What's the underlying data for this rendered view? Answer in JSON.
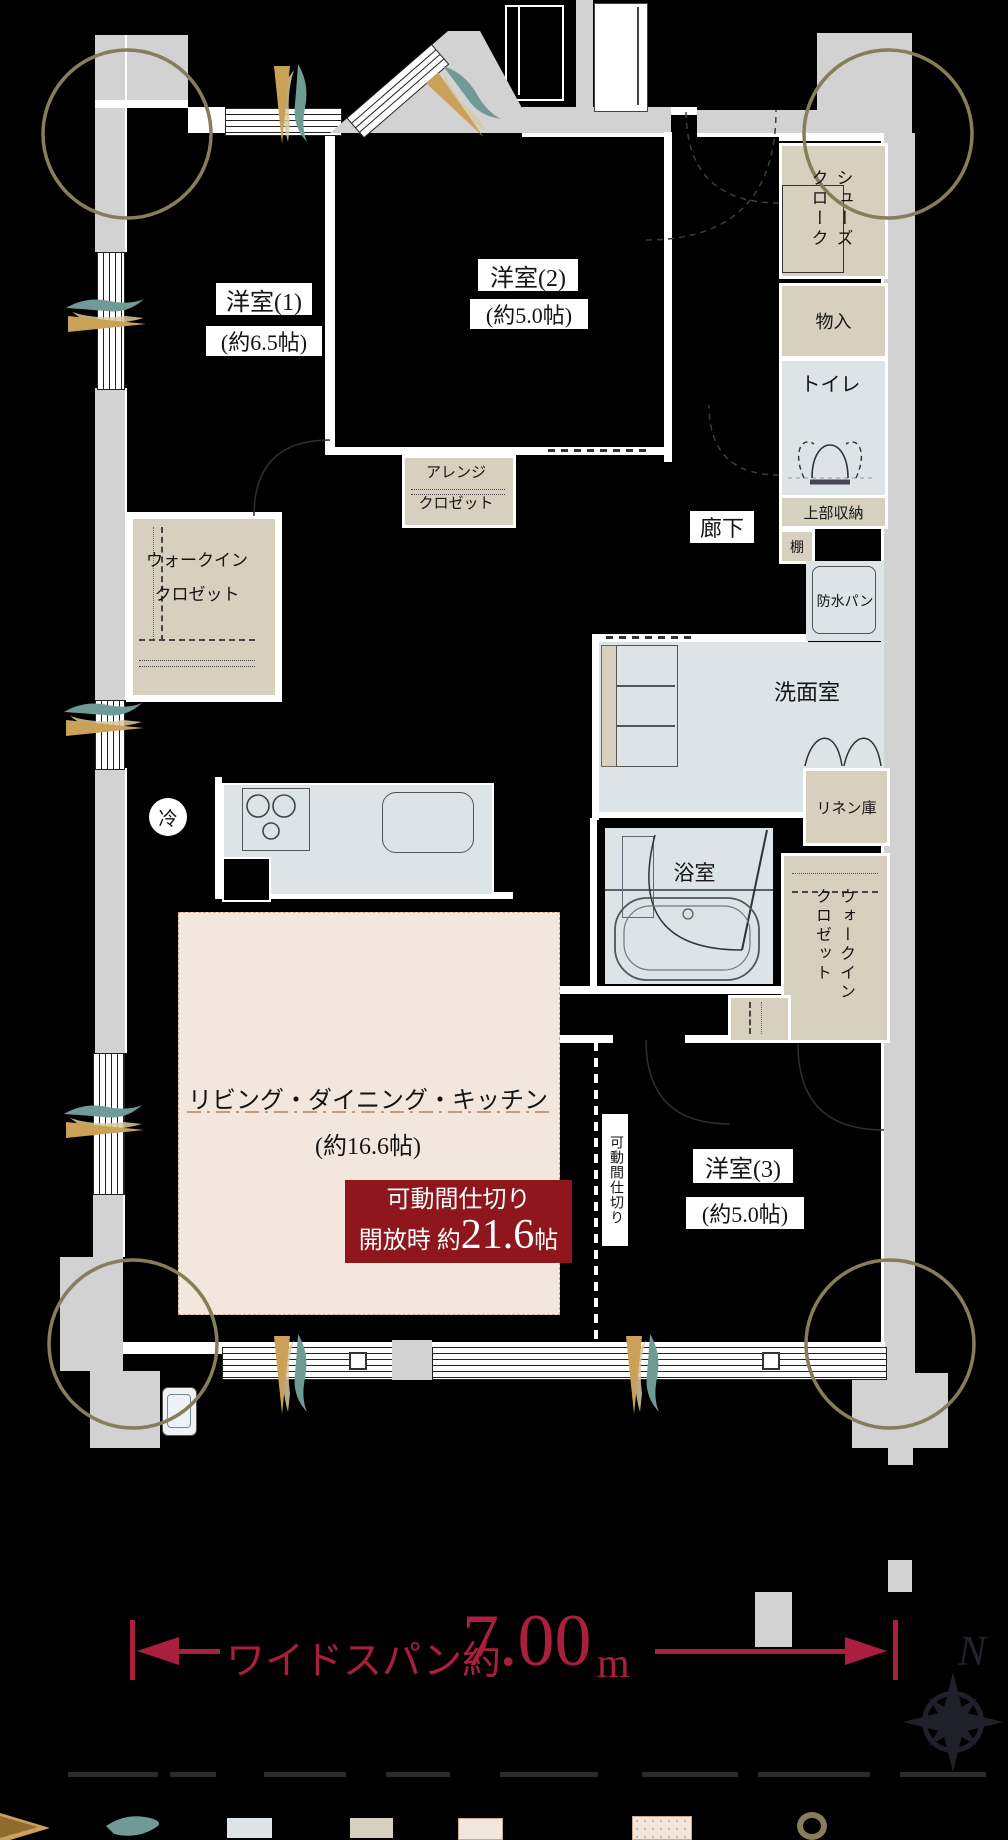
{
  "meta": {
    "type": "apartment-floor-plan"
  },
  "colors": {
    "wall_gray": "#d2d2d2",
    "wet_area": "#dce4e8",
    "closet_beige": "#d7d0bf",
    "ldk_pink": "#f3e7dd",
    "accent_crimson": "#aa1f3e",
    "callout_red": "#8e161c",
    "corner_ring_olive": "#867d5a"
  },
  "rooms": {
    "y1": {
      "name": "洋室(1)",
      "size": "(約6.5帖)"
    },
    "y2": {
      "name": "洋室(2)",
      "size": "(約5.0帖)"
    },
    "y3": {
      "name": "洋室(3)",
      "size": "(約5.0帖)"
    },
    "ldk": {
      "name": "リビング・ダイニング・キッチン",
      "size": "(約16.6帖)"
    },
    "hallway": "廊下",
    "washroom": "洗面室",
    "bathroom": "浴室",
    "toilet": "トイレ"
  },
  "storage": {
    "shoe_cloak": "シューズ\nクローク",
    "storage_small": "物入",
    "upper_storage": "上部収納",
    "shelf": "棚",
    "waterproof_pan": "防水パン",
    "linen": "リネン庫",
    "wic1_line1": "ウォークイン",
    "wic1_line2": "クロゼット",
    "wic2": "ウォークイン\nクロゼット",
    "arrange_line1": "アレンジ",
    "arrange_line2": "クロゼット",
    "fridge": "冷"
  },
  "partition": {
    "vertical_label": "可動間仕切り",
    "callout_line1": "可動間仕切り",
    "callout_line2_prefix": "開放時 約",
    "callout_line2_value": "21.6",
    "callout_line2_suffix": "帖"
  },
  "dimension": {
    "prefix": "ワイドスパン約",
    "value": "7.00",
    "unit": "m"
  },
  "compass": {
    "north": "N"
  }
}
